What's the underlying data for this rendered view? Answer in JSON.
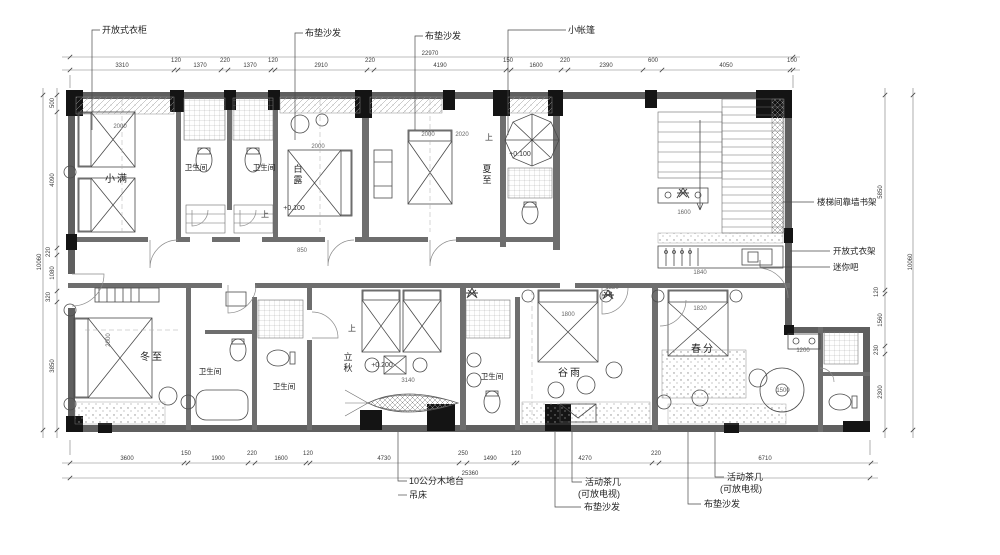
{
  "drawing": {
    "type": "hotel-guestroom-floor-plan",
    "accent_color": "#5f5f5f",
    "column_color": "#141414",
    "line_color": "#4a4a4a"
  },
  "callouts": {
    "top": [
      "开放式衣柜",
      "布垫沙发",
      "布垫沙发",
      "小帐篷"
    ],
    "right": [
      "楼梯间靠墙书架",
      "开放式衣架",
      "迷你吧"
    ],
    "bottom": [
      "10公分木地台",
      "吊床",
      "活动茶几",
      "(可放电视)",
      "布垫沙发",
      "活动茶几",
      "(可放电视)",
      "布垫沙发"
    ]
  },
  "rooms": [
    "小满",
    "卫生间",
    "卫生间",
    "白露",
    "夏至",
    "冬至",
    "卫生间",
    "卫生间",
    "立秋",
    "卫生间",
    "谷雨",
    "春分"
  ],
  "levels": [
    "+0.100",
    "+0.100",
    "+0.200"
  ],
  "dims": {
    "top": [
      "3310",
      "120",
      "1370",
      "220",
      "1370",
      "120",
      "2910",
      "220",
      "4190",
      "150",
      "1600",
      "220",
      "2390",
      "600",
      "4050",
      "100"
    ],
    "top_total": "22970",
    "bottom": [
      "3600",
      "150",
      "1900",
      "220",
      "1600",
      "120",
      "4730",
      "250",
      "1490",
      "120",
      "4270",
      "220",
      "6710"
    ],
    "bottom_total": "25360",
    "left": [
      "500",
      "4090",
      "220",
      "1080",
      "320",
      "3850"
    ],
    "left_total": "10060",
    "right": [
      "5850",
      "120",
      "1560",
      "230",
      "2300"
    ],
    "right_total": "10060",
    "inner": [
      "2000",
      "2000",
      "2000",
      "2020",
      "1800",
      "1820",
      "2000",
      "1600",
      "1500",
      "1200",
      "3140",
      "850",
      "1840",
      "1320"
    ]
  },
  "labels": [
    {
      "n": "callout-open-wardrobe",
      "t": "开放式衣柜",
      "x": 102,
      "y": 33,
      "s": 9,
      "a": "start",
      "c": "#222"
    },
    {
      "n": "callout-cushion-sofa-1",
      "t": "布垫沙发",
      "x": 305,
      "y": 36,
      "s": 9,
      "a": "start",
      "c": "#222"
    },
    {
      "n": "callout-cushion-sofa-2",
      "t": "布垫沙发",
      "x": 425,
      "y": 39,
      "s": 9,
      "a": "start",
      "c": "#222"
    },
    {
      "n": "callout-small-tent",
      "t": "小帐篷",
      "x": 568,
      "y": 33,
      "s": 9,
      "a": "start",
      "c": "#222"
    },
    {
      "n": "callout-stair-bookshelf",
      "t": "楼梯间靠墙书架",
      "x": 817,
      "y": 205,
      "s": 8.5,
      "a": "start",
      "c": "#222"
    },
    {
      "n": "callout-open-rack",
      "t": "开放式衣架",
      "x": 833,
      "y": 254,
      "s": 8.5,
      "a": "start",
      "c": "#222"
    },
    {
      "n": "callout-minibar",
      "t": "迷你吧",
      "x": 833,
      "y": 270,
      "s": 8.5,
      "a": "start",
      "c": "#222"
    },
    {
      "n": "callout-wood-platform",
      "t": "10公分木地台",
      "x": 409,
      "y": 484,
      "s": 9,
      "a": "start",
      "c": "#222"
    },
    {
      "n": "callout-hammock",
      "t": "吊床",
      "x": 409,
      "y": 498,
      "s": 9,
      "a": "start",
      "c": "#222"
    },
    {
      "n": "callout-tea-table-1",
      "t": "活动茶几",
      "x": 585,
      "y": 485,
      "s": 9,
      "a": "start",
      "c": "#222"
    },
    {
      "n": "callout-tea-table-1b",
      "t": "(可放电视)",
      "x": 578,
      "y": 497,
      "s": 9,
      "a": "start",
      "c": "#222"
    },
    {
      "n": "callout-cushion-sofa-3",
      "t": "布垫沙发",
      "x": 584,
      "y": 510,
      "s": 9,
      "a": "start",
      "c": "#222"
    },
    {
      "n": "callout-tea-table-2",
      "t": "活动茶几",
      "x": 727,
      "y": 480,
      "s": 9,
      "a": "start",
      "c": "#222"
    },
    {
      "n": "callout-tea-table-2b",
      "t": "(可放电视)",
      "x": 720,
      "y": 492,
      "s": 9,
      "a": "start",
      "c": "#222"
    },
    {
      "n": "callout-cushion-sofa-4",
      "t": "布垫沙发",
      "x": 704,
      "y": 507,
      "s": 9,
      "a": "start",
      "c": "#222"
    },
    {
      "n": "room-label-xiaoman",
      "t": "小满",
      "x": 117,
      "y": 182,
      "s": 10,
      "ls": 2,
      "c": "#222"
    },
    {
      "n": "room-label-bath-1",
      "t": "卫生间",
      "x": 196,
      "y": 170,
      "s": 7.5,
      "c": "#222"
    },
    {
      "n": "room-label-bath-2",
      "t": "卫生间",
      "x": 264,
      "y": 170,
      "s": 7.5,
      "c": "#222"
    },
    {
      "n": "room-label-bailu",
      "t": "白露",
      "x": 298,
      "y": 172,
      "s": 9,
      "v": 1,
      "c": "#222"
    },
    {
      "n": "room-label-xiazhi",
      "t": "夏至",
      "x": 487,
      "y": 172,
      "s": 9,
      "v": 1,
      "c": "#222"
    },
    {
      "n": "room-label-dongzhi",
      "t": "冬至",
      "x": 152,
      "y": 360,
      "s": 10,
      "ls": 2,
      "c": "#222"
    },
    {
      "n": "room-label-bath-3",
      "t": "卫生间",
      "x": 210,
      "y": 374,
      "s": 7.5,
      "c": "#222"
    },
    {
      "n": "room-label-bath-4",
      "t": "卫生间",
      "x": 284,
      "y": 389,
      "s": 7.5,
      "c": "#222"
    },
    {
      "n": "room-label-liqiu",
      "t": "立秋",
      "x": 348,
      "y": 360,
      "s": 9,
      "v": 1,
      "c": "#222"
    },
    {
      "n": "room-label-bath-5",
      "t": "卫生间",
      "x": 492,
      "y": 379,
      "s": 7.5,
      "c": "#222"
    },
    {
      "n": "room-label-guyu",
      "t": "谷雨",
      "x": 570,
      "y": 376,
      "s": 10,
      "ls": 2,
      "c": "#222"
    },
    {
      "n": "room-label-chunfen",
      "t": "春分",
      "x": 703,
      "y": 352,
      "s": 10,
      "ls": 2,
      "c": "#222"
    },
    {
      "n": "level-marker",
      "t": "+0.100",
      "x": 294,
      "y": 210,
      "s": 7,
      "c": "#333"
    },
    {
      "n": "level-marker",
      "t": "+0.100",
      "x": 520,
      "y": 156,
      "s": 7,
      "c": "#333"
    },
    {
      "n": "level-marker",
      "t": "+0.200",
      "x": 382,
      "y": 367,
      "s": 7,
      "c": "#333"
    },
    {
      "n": "up-mark",
      "t": "上",
      "x": 265,
      "y": 217,
      "s": 8,
      "c": "#333"
    },
    {
      "n": "up-mark",
      "t": "上",
      "x": 489,
      "y": 140,
      "s": 8,
      "c": "#333"
    },
    {
      "n": "up-mark",
      "t": "上",
      "x": 352,
      "y": 331,
      "s": 8,
      "c": "#333"
    },
    {
      "n": "dim-top",
      "t": "3310",
      "x": 122,
      "y": 67,
      "s": 6
    },
    {
      "n": "dim-top",
      "t": "120",
      "x": 176,
      "y": 62,
      "s": 6
    },
    {
      "n": "dim-top",
      "t": "1370",
      "x": 200,
      "y": 67,
      "s": 6
    },
    {
      "n": "dim-top",
      "t": "220",
      "x": 225,
      "y": 62,
      "s": 6
    },
    {
      "n": "dim-top",
      "t": "1370",
      "x": 250,
      "y": 67,
      "s": 6
    },
    {
      "n": "dim-top",
      "t": "120",
      "x": 273,
      "y": 62,
      "s": 6
    },
    {
      "n": "dim-top",
      "t": "2910",
      "x": 321,
      "y": 67,
      "s": 6
    },
    {
      "n": "dim-top",
      "t": "220",
      "x": 370,
      "y": 62,
      "s": 6
    },
    {
      "n": "dim-top",
      "t": "4190",
      "x": 440,
      "y": 67,
      "s": 6
    },
    {
      "n": "dim-top",
      "t": "150",
      "x": 508,
      "y": 62,
      "s": 6
    },
    {
      "n": "dim-top",
      "t": "1600",
      "x": 536,
      "y": 67,
      "s": 6
    },
    {
      "n": "dim-top",
      "t": "220",
      "x": 565,
      "y": 62,
      "s": 6
    },
    {
      "n": "dim-top",
      "t": "2390",
      "x": 606,
      "y": 67,
      "s": 6
    },
    {
      "n": "dim-top",
      "t": "600",
      "x": 653,
      "y": 62,
      "s": 6
    },
    {
      "n": "dim-top",
      "t": "4050",
      "x": 726,
      "y": 67,
      "s": 6
    },
    {
      "n": "dim-top",
      "t": "100",
      "x": 792,
      "y": 62,
      "s": 6
    },
    {
      "n": "dim-top-total",
      "t": "22970",
      "x": 430,
      "y": 55,
      "s": 6
    },
    {
      "n": "dim-bottom",
      "t": "3600",
      "x": 127,
      "y": 460,
      "s": 6
    },
    {
      "n": "dim-bottom",
      "t": "150",
      "x": 186,
      "y": 455,
      "s": 6
    },
    {
      "n": "dim-bottom",
      "t": "1900",
      "x": 218,
      "y": 460,
      "s": 6
    },
    {
      "n": "dim-bottom",
      "t": "220",
      "x": 252,
      "y": 455,
      "s": 6
    },
    {
      "n": "dim-bottom",
      "t": "1600",
      "x": 281,
      "y": 460,
      "s": 6
    },
    {
      "n": "dim-bottom",
      "t": "120",
      "x": 308,
      "y": 455,
      "s": 6
    },
    {
      "n": "dim-bottom",
      "t": "4730",
      "x": 384,
      "y": 460,
      "s": 6
    },
    {
      "n": "dim-bottom",
      "t": "250",
      "x": 463,
      "y": 455,
      "s": 6
    },
    {
      "n": "dim-bottom",
      "t": "1490",
      "x": 490,
      "y": 460,
      "s": 6
    },
    {
      "n": "dim-bottom",
      "t": "120",
      "x": 516,
      "y": 455,
      "s": 6
    },
    {
      "n": "dim-bottom",
      "t": "4270",
      "x": 585,
      "y": 460,
      "s": 6
    },
    {
      "n": "dim-bottom",
      "t": "220",
      "x": 656,
      "y": 455,
      "s": 6
    },
    {
      "n": "dim-bottom",
      "t": "6710",
      "x": 765,
      "y": 460,
      "s": 6
    },
    {
      "n": "dim-bottom-total",
      "t": "25360",
      "x": 470,
      "y": 475,
      "s": 6
    },
    {
      "n": "dim-left",
      "t": "500",
      "x": 54,
      "y": 103,
      "s": 6,
      "r": -90
    },
    {
      "n": "dim-left",
      "t": "4090",
      "x": 54,
      "y": 180,
      "s": 6,
      "r": -90
    },
    {
      "n": "dim-left",
      "t": "220",
      "x": 50,
      "y": 252,
      "s": 6,
      "r": -90
    },
    {
      "n": "dim-left",
      "t": "1080",
      "x": 54,
      "y": 273,
      "s": 6,
      "r": -90
    },
    {
      "n": "dim-left",
      "t": "320",
      "x": 50,
      "y": 297,
      "s": 6,
      "r": -90
    },
    {
      "n": "dim-left",
      "t": "3850",
      "x": 54,
      "y": 366,
      "s": 6,
      "r": -90
    },
    {
      "n": "dim-left-total",
      "t": "10060",
      "x": 41,
      "y": 262,
      "s": 6,
      "r": -90
    },
    {
      "n": "dim-right",
      "t": "5850",
      "x": 882,
      "y": 192,
      "s": 6,
      "r": -90
    },
    {
      "n": "dim-right",
      "t": "120",
      "x": 878,
      "y": 292,
      "s": 6,
      "r": -90
    },
    {
      "n": "dim-right",
      "t": "1560",
      "x": 882,
      "y": 320,
      "s": 6,
      "r": -90
    },
    {
      "n": "dim-right",
      "t": "230",
      "x": 878,
      "y": 350,
      "s": 6,
      "r": -90
    },
    {
      "n": "dim-right",
      "t": "2300",
      "x": 882,
      "y": 392,
      "s": 6,
      "r": -90
    },
    {
      "n": "dim-right-total",
      "t": "10060",
      "x": 912,
      "y": 262,
      "s": 6,
      "r": -90
    },
    {
      "n": "dim-inner",
      "t": "2000",
      "x": 120,
      "y": 128,
      "s": 6,
      "c": "#666"
    },
    {
      "n": "dim-inner",
      "t": "2000",
      "x": 318,
      "y": 148,
      "s": 6,
      "c": "#666"
    },
    {
      "n": "dim-inner",
      "t": "2000",
      "x": 428,
      "y": 136,
      "s": 6,
      "c": "#666"
    },
    {
      "n": "dim-inner",
      "t": "2020",
      "x": 462,
      "y": 136,
      "s": 6,
      "c": "#666"
    },
    {
      "n": "dim-inner",
      "t": "1800",
      "x": 568,
      "y": 316,
      "s": 6,
      "c": "#666"
    },
    {
      "n": "dim-inner",
      "t": "1820",
      "x": 700,
      "y": 310,
      "s": 6,
      "c": "#666"
    },
    {
      "n": "dim-inner",
      "t": "2000",
      "x": 110,
      "y": 340,
      "s": 6,
      "r": -90,
      "c": "#666"
    },
    {
      "n": "dim-inner",
      "t": "1600",
      "x": 684,
      "y": 214,
      "s": 6,
      "c": "#666"
    },
    {
      "n": "dim-inner",
      "t": "1500",
      "x": 783,
      "y": 392,
      "s": 6,
      "c": "#666"
    },
    {
      "n": "dim-inner",
      "t": "1200",
      "x": 803,
      "y": 352,
      "s": 6,
      "c": "#666"
    },
    {
      "n": "dim-inner",
      "t": "3140",
      "x": 408,
      "y": 382,
      "s": 6,
      "c": "#666"
    },
    {
      "n": "dim-inner",
      "t": "850",
      "x": 302,
      "y": 252,
      "s": 6,
      "c": "#666"
    },
    {
      "n": "dim-inner",
      "t": "1840",
      "x": 700,
      "y": 274,
      "s": 6,
      "c": "#666"
    },
    {
      "n": "dim-inner",
      "t": "1320",
      "x": 612,
      "y": 289,
      "s": 6,
      "c": "#666"
    }
  ]
}
